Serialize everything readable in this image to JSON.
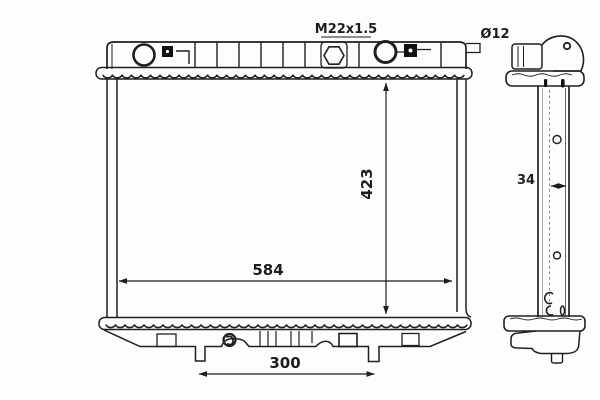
{
  "drawing": {
    "type": "radiator-technical-drawing",
    "views": [
      "front",
      "side"
    ],
    "colors": {
      "line": "#1f1f1f",
      "thin_line": "#5a5a5a",
      "dashed_line": "#777777",
      "background": "#fdfdfd",
      "fill_solid": "#111111"
    },
    "labels": {
      "thread": "M22x1.5",
      "inlet_diameter": "Ø12",
      "height": "423",
      "width": "584",
      "pin_spacing": "300",
      "core_thickness": "34"
    }
  }
}
